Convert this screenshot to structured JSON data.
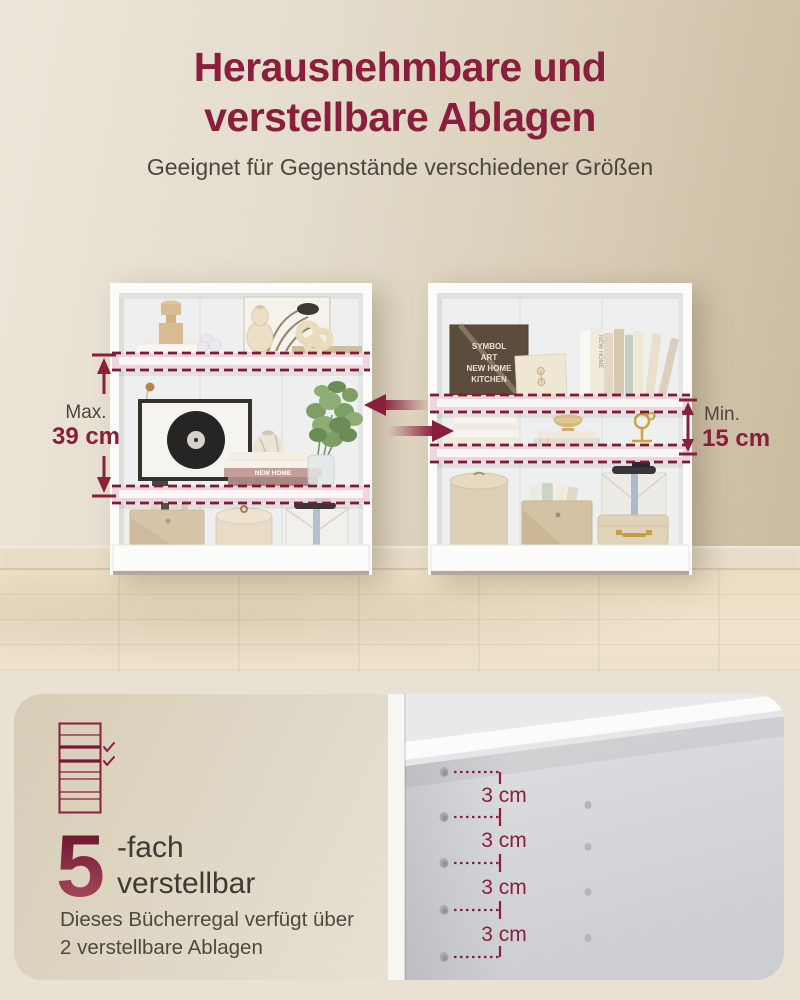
{
  "header": {
    "title_line1": "Herausnehmbare und",
    "title_line2": "verstellbare Ablagen",
    "subtitle": "Geeignet für Gegenstände verschiedener Größen"
  },
  "measurements": {
    "left": {
      "label": "Max.",
      "value": "39 cm"
    },
    "right": {
      "label": "Min.",
      "value": "15 cm"
    }
  },
  "feature": {
    "count": "5",
    "suffix_line1": "-fach",
    "suffix_line2": "verstellbar",
    "desc_line1": "Dieses Bücherregal verfügt über",
    "desc_line2": "2 verstellbare Ablagen"
  },
  "photo": {
    "spacing_labels": [
      "3 cm",
      "3 cm",
      "3 cm",
      "3 cm"
    ]
  },
  "scene": {
    "left_bookcase": {
      "book_spine_text": "NEW HOME"
    },
    "right_bookcase": {
      "box_lines": [
        "SYMBOL",
        "ART",
        "NEW HOME",
        "KITCHEN"
      ],
      "book_spine_text": "NEW HOME"
    }
  },
  "colors": {
    "accent": "#8a1e3d",
    "text_dark": "#45403a",
    "wall_beige": "#d8cdb8",
    "card_beige": "#dcd2bf",
    "page_beige": "#e9e2d4",
    "photo_gray": "#d3d4d7",
    "highlight_pink": "#edd2dc"
  }
}
